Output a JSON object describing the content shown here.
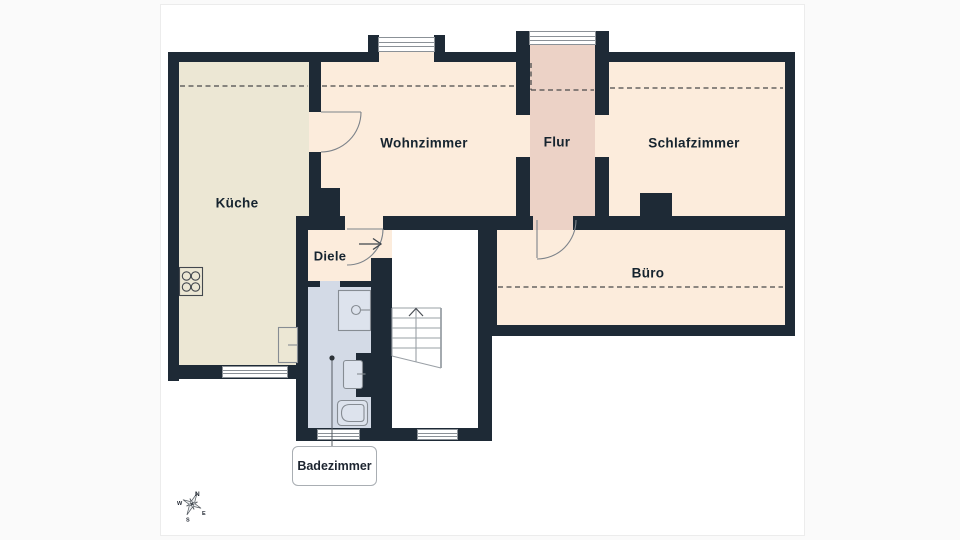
{
  "plan": {
    "type": "floorplan",
    "rooms": {
      "kueche": "Küche",
      "wohnzimmer": "Wohnzimmer",
      "flur": "Flur",
      "schlafzimmer": "Schlafzimmer",
      "buero": "Büro",
      "diele": "Diele"
    },
    "callout": {
      "label": "Badezimmer"
    },
    "compass": {
      "north": "N",
      "east": "E",
      "south": "S",
      "west": "W"
    },
    "colors": {
      "wall": "#1e2a36",
      "kueche_floor": "#ece7d4",
      "cream_floor": "#fcecdc",
      "flur_floor": "#ecd2c6",
      "bath_floor": "#d3dae6",
      "stair_floor": "#ffffff",
      "dashed_roof_line": "#4a4a4a",
      "door_symbol": "#7d838a",
      "label_text": "#16242f"
    }
  }
}
